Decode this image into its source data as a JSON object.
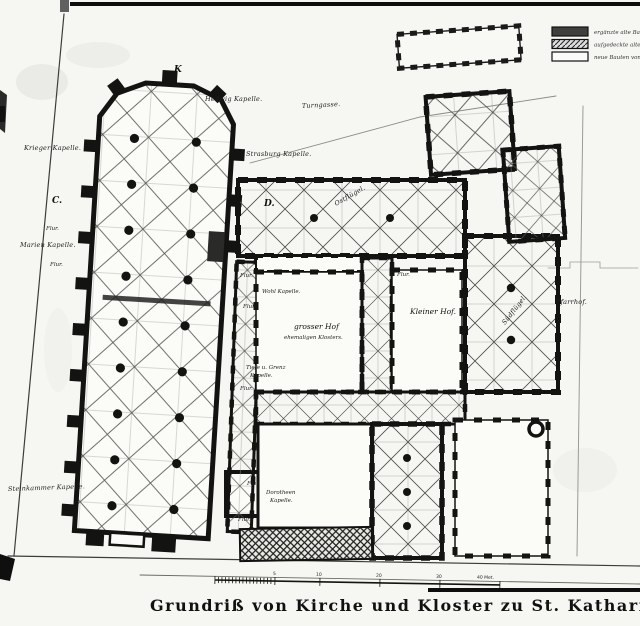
{
  "title": "Grundriß von Kirche und Kloster zu St. Katharinen",
  "legend": {
    "items": [
      {
        "swatch": "solid",
        "label": "ergänzte alte Bauten."
      },
      {
        "swatch": "hatched",
        "label": "aufgedeckte alte Mauern."
      },
      {
        "swatch": "outline",
        "label": "neue Bauten von 1888."
      }
    ]
  },
  "labels": {
    "street_top": "Turngasse.",
    "hedwig": "Hedwig Kapelle.",
    "strasburg": "Strasburg Kapelle.",
    "krieger": "Krieger Kapelle.",
    "marien": "Marien Kapelle.",
    "steinkammer": "Steinkammer Kapelle.",
    "dorotheen_1": "Dorotheen",
    "dorotheen_2": "Kapelle.",
    "flur": "Flur.",
    "wohl": "Wohl Kapelle.",
    "grosser_hof_1": "grosser Hof",
    "grosser_hof_2": "ehemaligen Klosters.",
    "tiefe_1": "Tiefe u. Grenz",
    "tiefe_2": "Kapelle.",
    "kleiner_hof": "Kleiner Hof.",
    "ostfluegel": "Ostflügel.",
    "suedfluegel": "Südflügel.",
    "pfarrhof": "Pfarrhof."
  },
  "markers": {
    "k": "K",
    "c": "C.",
    "d": "D."
  },
  "scale": {
    "tick_labels": [
      "5",
      "10",
      "20",
      "30"
    ],
    "end_label": "40 Met."
  }
}
